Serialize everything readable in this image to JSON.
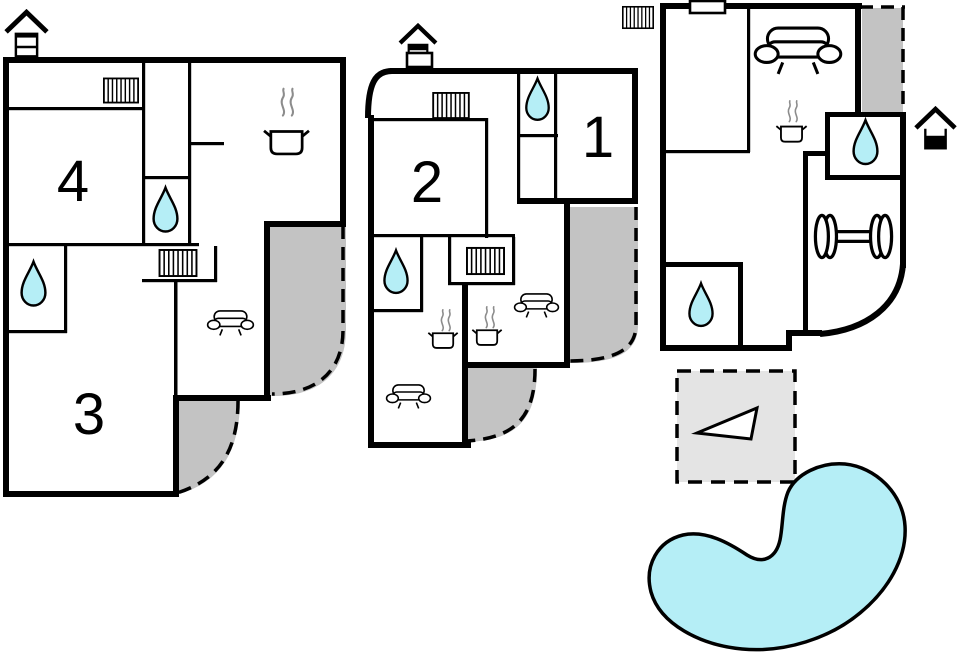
{
  "page": {
    "type": "holiday-home-floor-plan",
    "background": "#ffffff"
  },
  "colors": {
    "paper": "#ffffff",
    "wall": "#000000",
    "water": "#b5eef6",
    "pool": "#b5eef6",
    "terrace": "#c3c3c3",
    "patio": "#e4e4e4",
    "steam": "#8c8c8c"
  },
  "labels": {
    "room1": "1",
    "room2": "2",
    "room3": "3",
    "room4": "4"
  },
  "units": [
    {
      "id": "unit-left",
      "floor_level_icon": "top-floor-of-3-storey-house",
      "rooms": [
        "4",
        "3"
      ],
      "features": [
        "radiator",
        "kitchen-pot-with-steam",
        "shower",
        "shower",
        "radiator",
        "sofa",
        "curved-terrace",
        "curved-terrace"
      ]
    },
    {
      "id": "unit-middle",
      "floor_level_icon": "upper-floor-of-2-storey-house",
      "rooms": [
        "2",
        "1"
      ],
      "features": [
        "entrance-door",
        "radiator",
        "shower",
        "shower",
        "radiator",
        "kitchen-pot-with-steam",
        "kitchen-pot-with-steam",
        "sofa",
        "sofa",
        "curved-terrace",
        "curved-terrace"
      ]
    },
    {
      "id": "unit-right",
      "floor_level_icon": "ground-floor-of-2-storey-house",
      "rooms": [],
      "features": [
        "radiator",
        "entrance-door",
        "sofa",
        "kitchen-pot-with-steam",
        "shower",
        "shower",
        "fitness-dumbbell",
        "terrace"
      ]
    }
  ],
  "outdoor": {
    "items": [
      "patio-with-sail-triangle",
      "swimming-pool"
    ]
  }
}
